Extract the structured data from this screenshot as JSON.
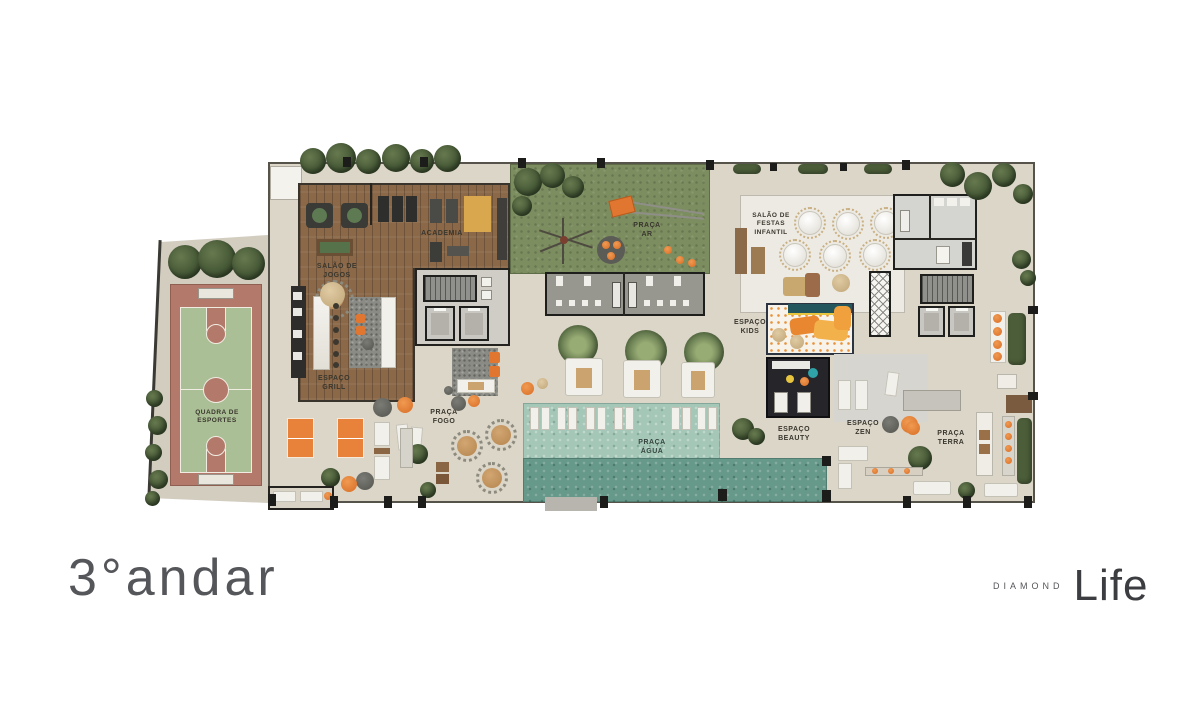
{
  "page": {
    "background": "#ffffff",
    "type": "residential amenities floor plan"
  },
  "title": {
    "floor": "3°andar"
  },
  "brand": {
    "prefix": "DIAMOND",
    "name": "Life"
  },
  "areas": {
    "quadra": "QUADRA DE\nESPORTES",
    "jogos": "SALÃO DE\nJOGOS",
    "academia": "ACADEMIA",
    "praca_ar": "PRAÇA\nAR",
    "festas": "SALÃO DE\nFESTAS\nINFANTIL",
    "grill": "ESPAÇO\nGRILL",
    "fogo": "PRAÇA\nFOGO",
    "agua": "PRAÇA\nÁGUA",
    "kids": "ESPAÇO\nKIDS",
    "beauty": "ESPAÇO\nBEAUTY",
    "zen": "ESPAÇO\nZEN",
    "terra": "PRAÇA\nTERRA"
  },
  "colors": {
    "deck": "#dcd6c9",
    "wood": "#8a6848",
    "lawn": "#7c8d60",
    "pool_light": "#a5c7b8",
    "pool_dark": "#67998a",
    "court_clay": "#b37a6b",
    "court_green": "#aabf95",
    "accent_orange": "#e0762f",
    "wall": "#26251f"
  }
}
